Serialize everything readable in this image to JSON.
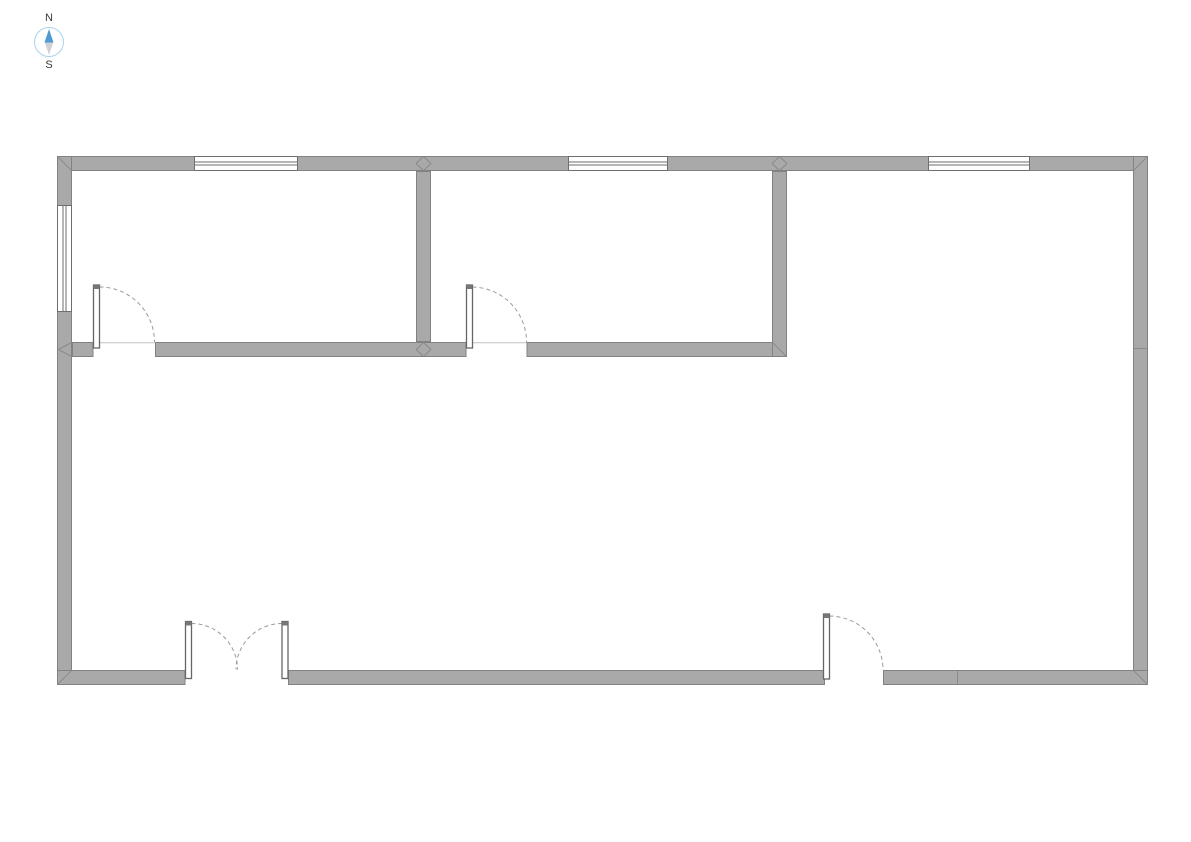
{
  "compass": {
    "north_label": "N",
    "south_label": "S",
    "ring_color": "#a8d2ec",
    "needle_color": "#4f9ad2",
    "tail_color": "#cdd2d6",
    "label_color": "#3a3a3a"
  },
  "palette": {
    "background": "#ffffff",
    "wall_fill": "#a9a9a9",
    "wall_stroke": "#828282",
    "joint_stroke": "#8a8a8a",
    "window_fill": "#ffffff",
    "window_stroke": "#6e6e6e",
    "door_leaf_fill": "#ffffff",
    "door_leaf_stroke": "#666666",
    "door_cap_fill": "#777777",
    "arc_stroke": "#9a9a9a",
    "threshold_stroke": "#c2c2c2"
  },
  "floorplan": {
    "width": 1191,
    "height": 842,
    "walls": [
      {
        "name": "north-wall",
        "x": 57,
        "y": 156,
        "w": 1091,
        "h": 15
      },
      {
        "name": "west-wall",
        "x": 57,
        "y": 156,
        "w": 15,
        "h": 529
      },
      {
        "name": "east-wall",
        "x": 1133,
        "y": 156,
        "w": 15,
        "h": 529
      },
      {
        "name": "south-wall-left",
        "x": 57,
        "y": 670,
        "w": 128.5,
        "h": 15
      },
      {
        "name": "south-wall-middle",
        "x": 288,
        "y": 670,
        "w": 537,
        "h": 15
      },
      {
        "name": "south-wall-right",
        "x": 883,
        "y": 670,
        "w": 265,
        "h": 15
      },
      {
        "name": "interior-wall-left",
        "x": 72,
        "y": 342,
        "w": 21.5,
        "h": 15
      },
      {
        "name": "interior-wall-center",
        "x": 155,
        "y": 342,
        "w": 311.5,
        "h": 15
      },
      {
        "name": "interior-wall-right",
        "x": 526.5,
        "y": 342,
        "w": 260.5,
        "h": 15
      },
      {
        "name": "partition-wall-a",
        "x": 416,
        "y": 171,
        "w": 15,
        "h": 171
      },
      {
        "name": "partition-wall-b",
        "x": 772,
        "y": 171,
        "w": 15,
        "h": 186
      }
    ],
    "windows": [
      {
        "name": "window-north-1",
        "x": 194,
        "y": 156,
        "w": 104,
        "h": 15,
        "orientation": "horizontal"
      },
      {
        "name": "window-north-2",
        "x": 568,
        "y": 156,
        "w": 100,
        "h": 15,
        "orientation": "horizontal"
      },
      {
        "name": "window-north-3",
        "x": 928,
        "y": 156,
        "w": 102,
        "h": 15,
        "orientation": "horizontal"
      },
      {
        "name": "window-west",
        "x": 57,
        "y": 205,
        "w": 15,
        "h": 107,
        "orientation": "vertical"
      }
    ],
    "doors": [
      {
        "name": "door-room-1",
        "leaf": {
          "x": 93.5,
          "y": 285,
          "w": 6,
          "h": 63
        },
        "cap": {
          "x": 93.5,
          "y": 285,
          "w": 6,
          "h": 4
        },
        "arc": "M 99.5 287 A 55 55 0 0 1 154.5 342",
        "threshold": {
          "x1": 99.5,
          "y1": 342.8,
          "x2": 155,
          "y2": 342.8
        }
      },
      {
        "name": "door-room-2",
        "leaf": {
          "x": 466.5,
          "y": 285,
          "w": 6,
          "h": 63
        },
        "cap": {
          "x": 466.5,
          "y": 285,
          "w": 6,
          "h": 4
        },
        "arc": "M 472.5 287 A 55 55 0 0 1 526.5 342",
        "threshold": {
          "x1": 472.5,
          "y1": 342.8,
          "x2": 526.5,
          "y2": 342.8
        }
      },
      {
        "name": "entrance-door-left-leaf",
        "leaf": {
          "x": 185.5,
          "y": 621.5,
          "w": 6,
          "h": 57
        },
        "cap": {
          "x": 185.5,
          "y": 621.5,
          "w": 6,
          "h": 4
        },
        "arc": "M 191.5 623.5 A 46 46 0 0 1 237.5 669.5",
        "threshold": null
      },
      {
        "name": "entrance-door-right-leaf",
        "leaf": {
          "x": 282,
          "y": 621.5,
          "w": 6,
          "h": 57
        },
        "cap": {
          "x": 282,
          "y": 621.5,
          "w": 6,
          "h": 4
        },
        "arc": "M 282 623.5 A 46 46 0 0 0 236 669.5",
        "threshold": null
      },
      {
        "name": "door-southeast",
        "leaf": {
          "x": 823.5,
          "y": 614,
          "w": 6,
          "h": 65
        },
        "cap": {
          "x": 823.5,
          "y": 614,
          "w": 6,
          "h": 4
        },
        "arc": "M 829.5 616 A 54 54 0 0 1 883 670",
        "threshold": null
      }
    ],
    "joints": [
      {
        "x1": 57.5,
        "y1": 156.5,
        "x2": 71.5,
        "y2": 170.5
      },
      {
        "x1": 1147.5,
        "y1": 156.5,
        "x2": 1133.5,
        "y2": 170.5
      },
      {
        "x1": 1147.5,
        "y1": 684.5,
        "x2": 1133.5,
        "y2": 670.5
      },
      {
        "x1": 57.5,
        "y1": 684.5,
        "x2": 71.5,
        "y2": 670.5
      },
      {
        "x1": 416,
        "y1": 163.5,
        "x2": 423.5,
        "y2": 156.5
      },
      {
        "x1": 423.5,
        "y1": 156.5,
        "x2": 431,
        "y2": 163.5
      },
      {
        "x1": 416,
        "y1": 163.5,
        "x2": 423.5,
        "y2": 170.5
      },
      {
        "x1": 423.5,
        "y1": 170.5,
        "x2": 431,
        "y2": 163.5
      },
      {
        "x1": 416,
        "y1": 349.5,
        "x2": 423.5,
        "y2": 342.5
      },
      {
        "x1": 423.5,
        "y1": 342.5,
        "x2": 431,
        "y2": 349.5
      },
      {
        "x1": 416,
        "y1": 349.5,
        "x2": 423.5,
        "y2": 356.5
      },
      {
        "x1": 423.5,
        "y1": 356.5,
        "x2": 431,
        "y2": 349.5
      },
      {
        "x1": 772,
        "y1": 163.5,
        "x2": 779.5,
        "y2": 156.5
      },
      {
        "x1": 779.5,
        "y1": 156.5,
        "x2": 787,
        "y2": 163.5
      },
      {
        "x1": 772,
        "y1": 163.5,
        "x2": 779.5,
        "y2": 170.5
      },
      {
        "x1": 779.5,
        "y1": 170.5,
        "x2": 787,
        "y2": 163.5
      },
      {
        "x1": 772.5,
        "y1": 342.5,
        "x2": 786.5,
        "y2": 356.5
      },
      {
        "x1": 71.5,
        "y1": 342.5,
        "x2": 58.5,
        "y2": 349.5
      },
      {
        "x1": 58.5,
        "y1": 349.5,
        "x2": 71.5,
        "y2": 356.5
      },
      {
        "x1": 1133.5,
        "y1": 348.5,
        "x2": 1147.5,
        "y2": 348.5
      },
      {
        "x1": 957.5,
        "y1": 670.5,
        "x2": 957.5,
        "y2": 684.5
      }
    ]
  }
}
